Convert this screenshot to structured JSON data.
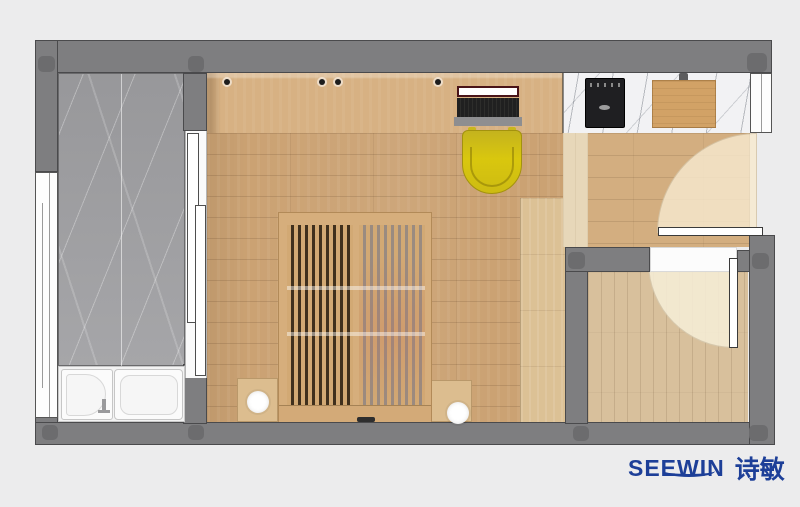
{
  "meta": {
    "kind": "interior floor plan render, top view",
    "rooms": [
      "bathroom",
      "main-bedroom-with-desk",
      "kitchen-hall",
      "entry-room"
    ]
  },
  "brand": {
    "latin": "SEEWIN",
    "cjk": "诗敏",
    "color": "#1d3f98"
  },
  "palette": {
    "background": "#ececed",
    "wall": "#7e7e80",
    "wall_column": "#6c6c6e",
    "wood_floor": "#cba273",
    "wood_hall": "#d3ae80",
    "wood_entry": "#d8c09c",
    "wood_desk": "#d7b183",
    "marble_gray": "#a1a1a4",
    "marble_white": "#f2f2f4",
    "chair_yellow": "#d9c70e",
    "stove_black": "#1f1f22",
    "fixture_white": "#ffffff"
  },
  "icons": [
    "bathtub-icon",
    "shower-tray-icon",
    "faucet-icon",
    "sliding-door-icon",
    "window-icon",
    "door-swing-icon",
    "cooktop-icon",
    "cutting-board-icon",
    "laptop-icon",
    "desk-chair-icon",
    "slatted-bed-icon",
    "nightstand-icon",
    "lamp-icon",
    "wall-column-icon"
  ]
}
